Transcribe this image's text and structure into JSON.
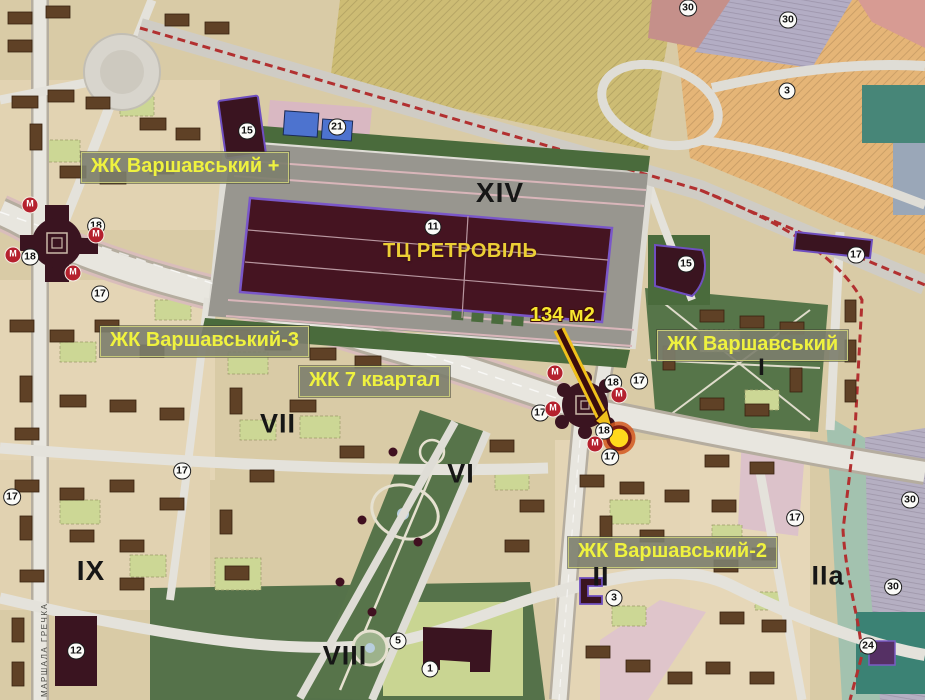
{
  "complex_labels": [
    {
      "text": "ЖК Варшавський +",
      "x": 81,
      "y": 152
    },
    {
      "text": "ЖК Варшавський-3",
      "x": 100,
      "y": 326
    },
    {
      "text": "ЖК 7 квартал",
      "x": 299,
      "y": 366
    },
    {
      "text": "ЖК Варшавський",
      "x": 657,
      "y": 330
    },
    {
      "text": "ЖК Варшавський-2",
      "x": 568,
      "y": 537
    }
  ],
  "mall_label": {
    "text": "ТЦ РЕТРОВІЛЬ"
  },
  "area_label": {
    "text": "134 м2"
  },
  "street_label": {
    "text": "МАРШАЛА ГРЕЧКА"
  },
  "district_labels": [
    {
      "text": "XIV",
      "x": 500,
      "y": 193,
      "size": 28
    },
    {
      "text": "I",
      "x": 762,
      "y": 368,
      "size": 24
    },
    {
      "text": "VII",
      "x": 278,
      "y": 424,
      "size": 27
    },
    {
      "text": "VI",
      "x": 461,
      "y": 474,
      "size": 27
    },
    {
      "text": "IX",
      "x": 91,
      "y": 571,
      "size": 28
    },
    {
      "text": "II",
      "x": 601,
      "y": 577,
      "size": 27
    },
    {
      "text": "IIa",
      "x": 828,
      "y": 576,
      "size": 27
    },
    {
      "text": "VIII",
      "x": 345,
      "y": 656,
      "size": 27
    }
  ],
  "badges": [
    {
      "n": "30",
      "x": 688,
      "y": 8
    },
    {
      "n": "30",
      "x": 788,
      "y": 20
    },
    {
      "n": "3",
      "x": 787,
      "y": 91
    },
    {
      "n": "15",
      "x": 247,
      "y": 131
    },
    {
      "n": "21",
      "x": 337,
      "y": 127
    },
    {
      "n": "11",
      "x": 433,
      "y": 227
    },
    {
      "n": "15",
      "x": 686,
      "y": 264
    },
    {
      "n": "17",
      "x": 856,
      "y": 255
    },
    {
      "n": "18",
      "x": 96,
      "y": 226
    },
    {
      "n": "18",
      "x": 30,
      "y": 257
    },
    {
      "n": "17",
      "x": 100,
      "y": 294
    },
    {
      "n": "17",
      "x": 12,
      "y": 497
    },
    {
      "n": "17",
      "x": 182,
      "y": 471
    },
    {
      "n": "18",
      "x": 613,
      "y": 383
    },
    {
      "n": "17",
      "x": 639,
      "y": 381
    },
    {
      "n": "17",
      "x": 540,
      "y": 413
    },
    {
      "n": "18",
      "x": 604,
      "y": 431
    },
    {
      "n": "17",
      "x": 610,
      "y": 457
    },
    {
      "n": "17",
      "x": 795,
      "y": 518
    },
    {
      "n": "3",
      "x": 614,
      "y": 598
    },
    {
      "n": "5",
      "x": 398,
      "y": 641
    },
    {
      "n": "1",
      "x": 430,
      "y": 669
    },
    {
      "n": "12",
      "x": 76,
      "y": 651
    },
    {
      "n": "24",
      "x": 868,
      "y": 646
    },
    {
      "n": "30",
      "x": 910,
      "y": 500
    },
    {
      "n": "30",
      "x": 893,
      "y": 587
    }
  ],
  "metro_badges": [
    {
      "text": "М",
      "x": 30,
      "y": 205
    },
    {
      "text": "М",
      "x": 13,
      "y": 255
    },
    {
      "text": "М",
      "x": 73,
      "y": 273
    },
    {
      "text": "М",
      "x": 96,
      "y": 235
    },
    {
      "text": "М",
      "x": 555,
      "y": 373
    },
    {
      "text": "М",
      "x": 553,
      "y": 409
    },
    {
      "text": "М",
      "x": 619,
      "y": 395
    },
    {
      "text": "М",
      "x": 595,
      "y": 444
    }
  ],
  "colors": {
    "label_text": "#eff23f",
    "label_bg": "#7c7e6d",
    "label_border": "#c6c97a",
    "mall_text": "#eccf35",
    "area_text": "#f7e72f",
    "district_text": "#161616",
    "marker_fill": "#ffd91c",
    "marker_ring": "#7e1d12",
    "arrow": "#f0c01c",
    "metro_badge": "#b5212e",
    "boundary_line": "#b23030",
    "mall_building": "#451421",
    "mall_outline": "#7a57c8",
    "park": "#57744a",
    "base": "#d9cba6",
    "parking": "#98968f"
  }
}
